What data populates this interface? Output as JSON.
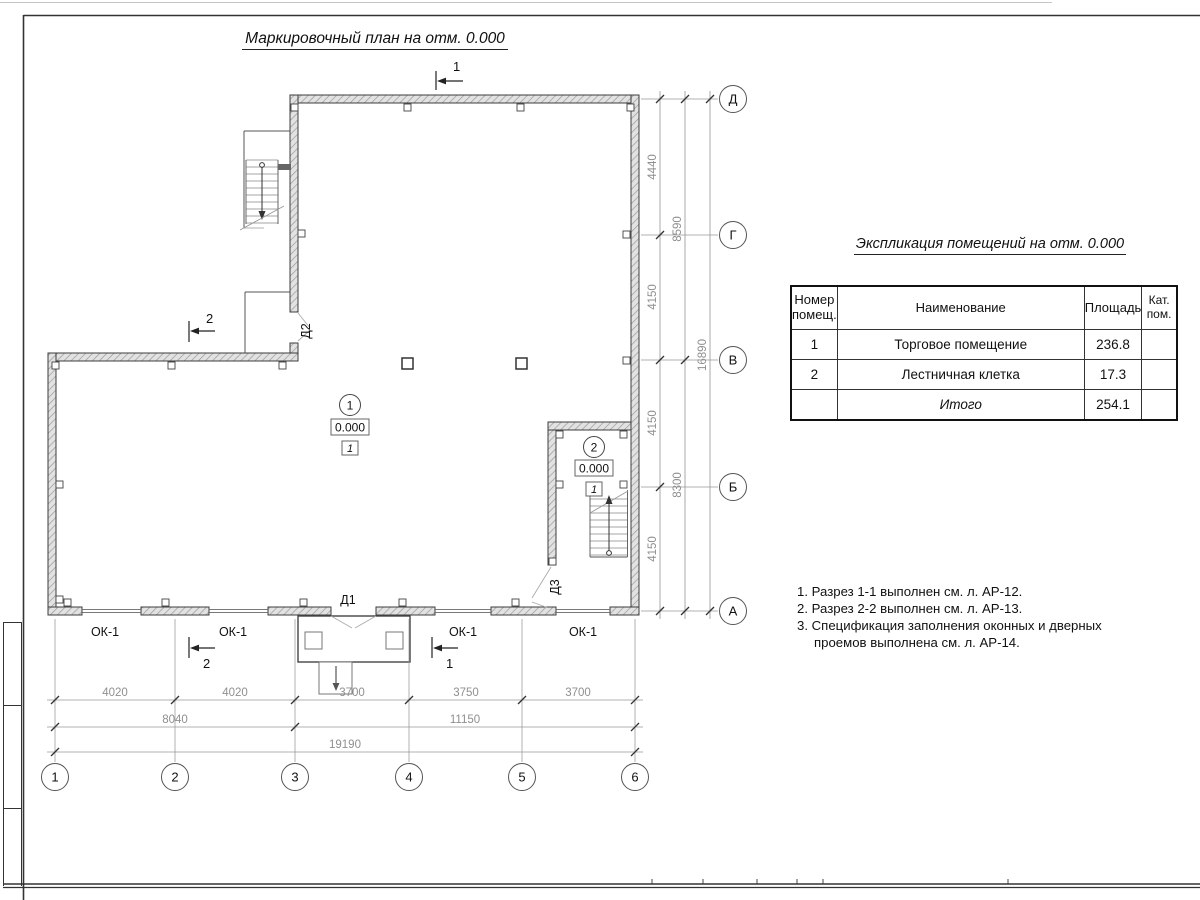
{
  "sheet": {
    "plan_title": "Маркировочный план на отм. 0.000"
  },
  "axes": {
    "horizontal": [
      "1",
      "2",
      "3",
      "4",
      "5",
      "6"
    ],
    "vertical": [
      "Д",
      "Г",
      "В",
      "Б",
      "А"
    ]
  },
  "dimensions": {
    "right_segments": [
      "4440",
      "4150",
      "4150",
      "4150"
    ],
    "right_sums": [
      "8590",
      "8300"
    ],
    "right_total": "16890",
    "bottom_segments": [
      "4020",
      "4020",
      "3700",
      "3750",
      "3700"
    ],
    "bottom_sums": [
      "8040",
      "11150"
    ],
    "bottom_total": "19190"
  },
  "section_marks": {
    "top": "1",
    "left": "2",
    "bottom_left": "2",
    "bottom_right": "1"
  },
  "plan_labels": {
    "door1": "Д1",
    "door2": "Д2",
    "door3": "Д3",
    "windows": [
      "ОК-1",
      "ОК-1",
      "ОК-1",
      "ОК-1"
    ],
    "room1": {
      "number": "1",
      "elevation": "0.000",
      "floor_mark": "1"
    },
    "room2": {
      "number": "2",
      "elevation": "0.000",
      "floor_mark": "1"
    }
  },
  "explication": {
    "title": "Экспликация помещений на отм. 0.000",
    "headers": {
      "number": "Номер помещ.",
      "name": "Наименование",
      "area": "Площадь",
      "category": "Кат. пом."
    },
    "rows": [
      {
        "number": "1",
        "name": "Торговое помещение",
        "area": "236.8",
        "category": ""
      },
      {
        "number": "2",
        "name": "Лестничная клетка",
        "area": "17.3",
        "category": ""
      }
    ],
    "total_label": "Итого",
    "total_area": "254.1"
  },
  "notes": [
    "1. Разрез 1-1 выполнен см. л. АР-12.",
    "2. Разрез 2-2 выполнен см. л. АР-13.",
    "3. Спецификация заполнения оконных и дверных проемов выполнена см. л. АР-14."
  ],
  "colors": {
    "wall_fill": "#e2e2e2",
    "wall_hatch": "#9a9a9a",
    "line": "#3c3c3c",
    "dim_text": "#8f8f8f"
  }
}
